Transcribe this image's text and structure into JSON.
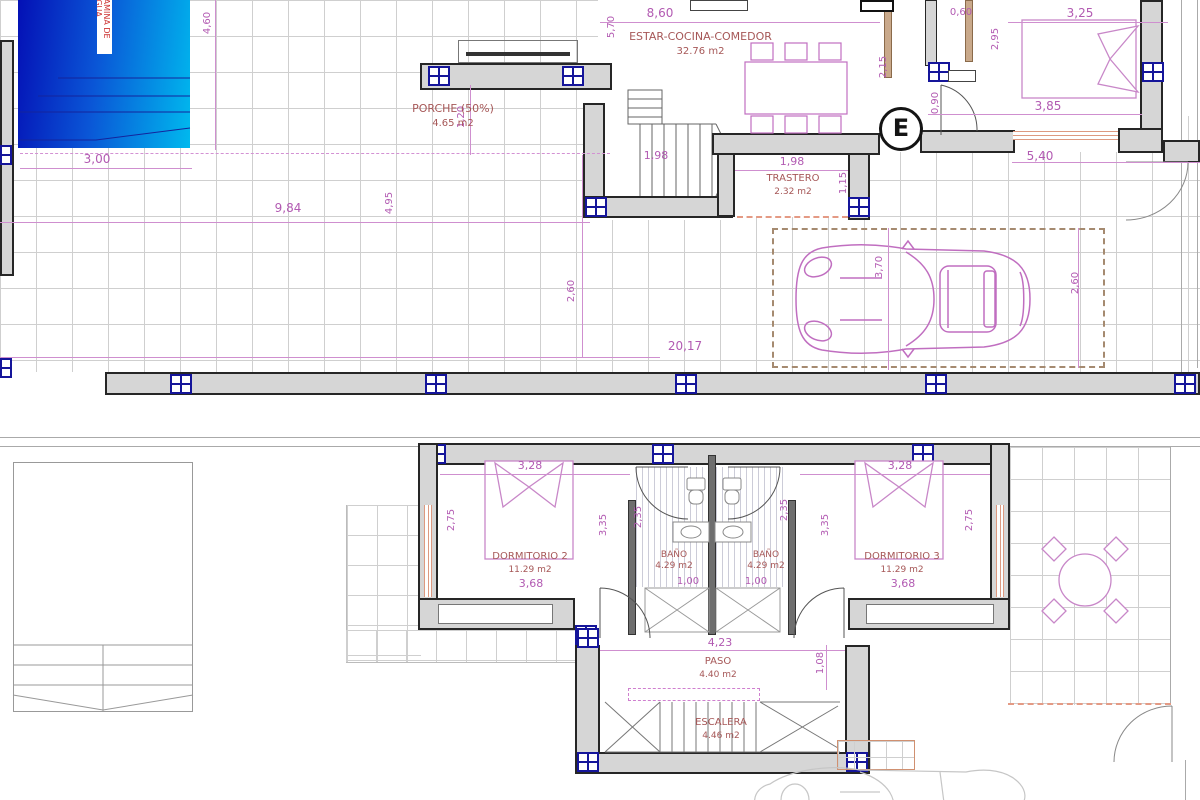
{
  "ground_floor": {
    "pool_label": "LAMINA DE AGUA",
    "electrical": "E",
    "rooms": {
      "porche": {
        "name": "PORCHE (50%)",
        "area": "4.65 m2"
      },
      "estar": {
        "name": "ESTAR-COCINA-COMEDOR",
        "area": "32.76 m2"
      },
      "trastero": {
        "name": "TRASTERO",
        "area": "2.32 m2"
      }
    },
    "dims": {
      "pool_w": "3,00",
      "pool_h": "4,60",
      "terrace_w": "9,84",
      "terrace_h": "4,95",
      "porch_depth": "1,20",
      "estar_h": "5,70",
      "estar_w": "8,60",
      "kitchen_h": "2,15",
      "top_door": "0,60",
      "bed_h": "2,95",
      "bed_w": "3,25",
      "bedroom_w": "3,85",
      "door_e": "0,90",
      "right_w": "5,40",
      "stairs_w": "1,98",
      "trastero_w": "1,98",
      "trastero_h": "1,15",
      "drive_left": "2,60",
      "drive_right": "2,60",
      "car_len": "3,70",
      "total_w": "20,17"
    }
  },
  "first_floor": {
    "rooms": {
      "dorm2": {
        "name": "DORMITORIO 2",
        "area": "11.29 m2",
        "width": "3,68"
      },
      "bano_left": {
        "name": "BAÑO",
        "area": "4.29 m2"
      },
      "bano_right": {
        "name": "BAÑO",
        "area": "4.29 m2"
      },
      "dorm3": {
        "name": "DORMITORIO 3",
        "area": "11.29 m2",
        "width": "3,68"
      },
      "paso": {
        "name": "PASO",
        "area": "4.40 m2"
      },
      "escalera": {
        "name": "ESCALERA",
        "area": "4.46 m2"
      }
    },
    "dims": {
      "dorm2_w": "3,28",
      "dorm2_side": "2,75",
      "dorm2_inner": "3,35",
      "bano_left_h": "2,35",
      "bano_left_w": "1,00",
      "bano_right_h": "2,35",
      "bano_right_w": "1,00",
      "dorm3_w": "3,28",
      "dorm3_side": "2,75",
      "dorm3_inner": "3,35",
      "paso_w": "4,23",
      "paso_side": "1,08"
    }
  },
  "colors": {
    "pool_gradient_start": "#0410b5",
    "pool_gradient_end": "#00b9ee",
    "dimension_text": "#b25ab2",
    "room_label_text": "#a65757",
    "column_marker": "#15159a",
    "furniture_outline": "#c06ec0",
    "wall_fill": "#d6d6d6"
  }
}
